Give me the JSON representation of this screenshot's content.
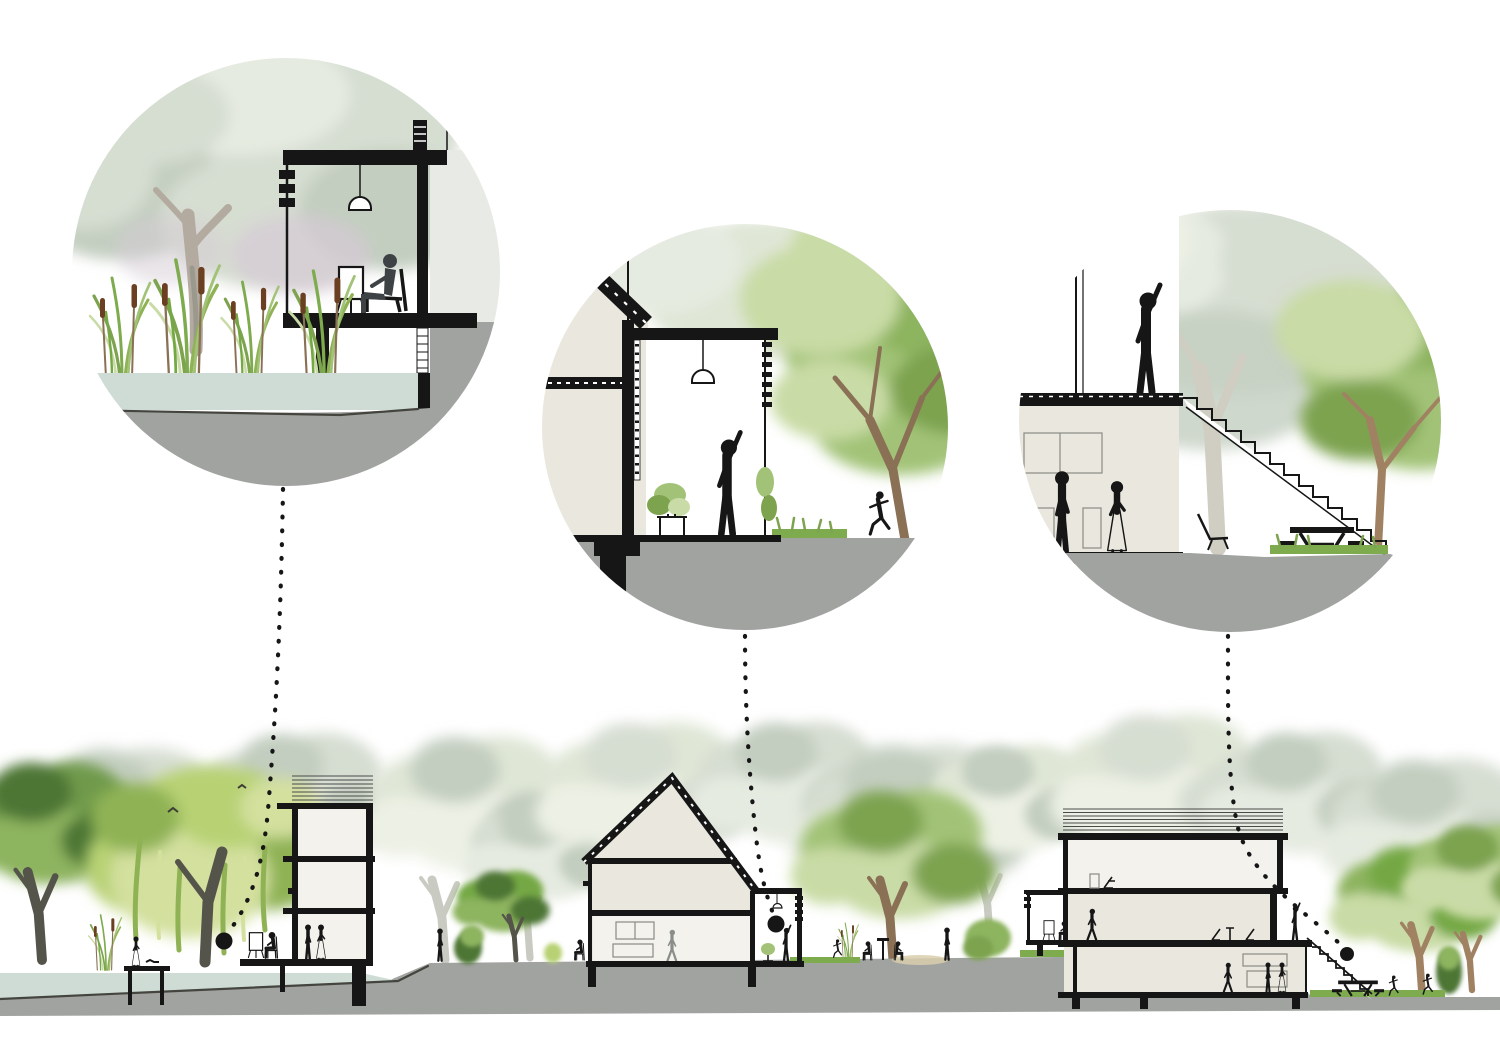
{
  "page": {
    "background": "#ffffff",
    "kind": "architectural-section-diagram-with-detail-callouts"
  },
  "palette": {
    "bg": "#ffffff",
    "ink": "#161616",
    "figure_dark": "#3f4244",
    "figure_gray": "#8a8d89",
    "cream": "#e9e7de",
    "cream_light": "#f3f2ec",
    "facade": "#e7eae5",
    "ground": "#a1a3a0",
    "ground_line": "#45453f",
    "water": "#cfdcd6",
    "grass": "#7dab4e",
    "willow": "#b7d173",
    "willow_dark": "#8fb254",
    "willow_light": "#d3e09e",
    "leaf": "#a2c377",
    "leaf_light": "#c9dba6",
    "leaf_dark": "#7da34f",
    "leaf_vivid": "#74a844",
    "leaf_deep": "#4e7636",
    "tree_dark": "#6f9a4c",
    "tree_dark_hi": "#8db45e",
    "fade": "#d6ddd1",
    "fade_light": "#e6ebe1",
    "fade_dark": "#c3cec0",
    "fade_green": "#dfe6d6",
    "fade_green_light": "#edf1e5",
    "lavender": "#d5cbd6",
    "trunk_brown": "#a08263",
    "trunk_brown2": "#8a7054",
    "trunk_dark": "#55544a",
    "trunk_pale": "#c9cbc2",
    "trunk_gray": "#b3ab9f",
    "trunk_fade": "#d0cdc3",
    "cattail": "#6b3f22",
    "stripe": "#4a4a4a",
    "panel": "#8b8b84",
    "sand": "#d9cfae"
  },
  "callouts": [
    {
      "id": "waterside-room-detail",
      "marker": {
        "x": 224,
        "y": 941
      }
    },
    {
      "id": "double-height-annex-detail",
      "marker": {
        "x": 776,
        "y": 924
      }
    },
    {
      "id": "roof-terrace-stair-detail",
      "marker": {
        "x": 1347,
        "y": 954
      }
    }
  ]
}
